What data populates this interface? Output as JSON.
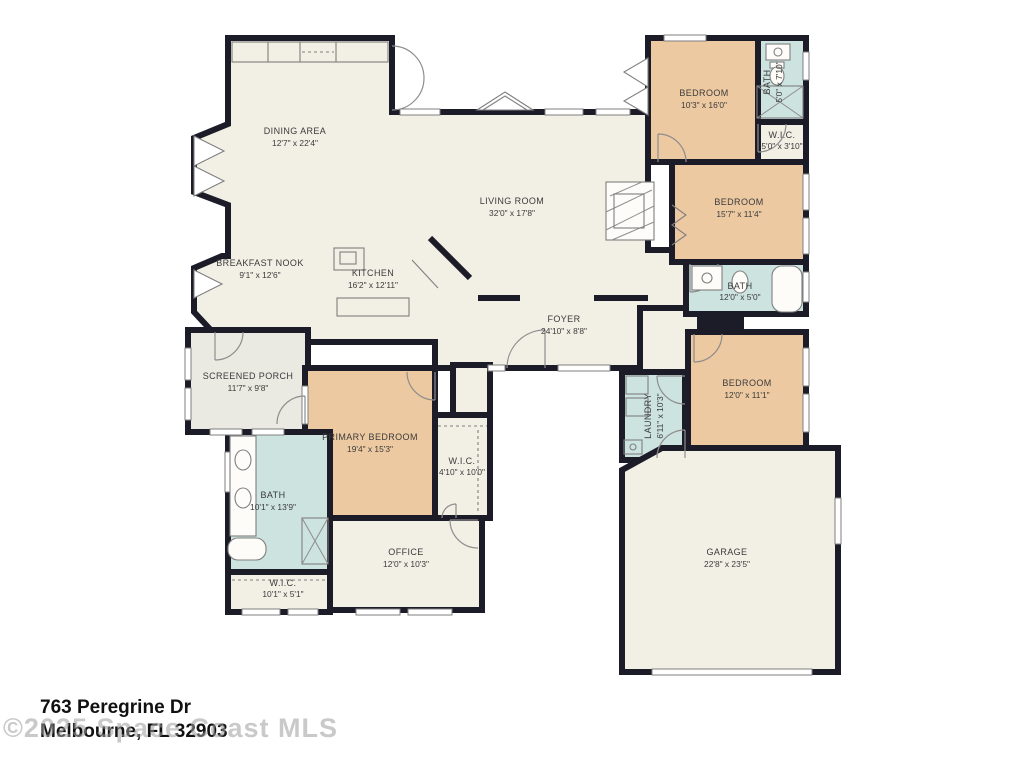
{
  "colors": {
    "wall": "#1c1c28",
    "bedroom": "#edc9a1",
    "bath": "#cde3df",
    "room": "#f2efe5",
    "porch": "#eaeae2",
    "label": "#3b3b3b",
    "address": "#111111",
    "watermark": "#9e9e9e"
  },
  "rooms": [
    {
      "name": "DINING AREA",
      "dims": "12'7\" x 22'4\""
    },
    {
      "name": "LIVING ROOM",
      "dims": "32'0\" x 17'8\""
    },
    {
      "name": "BREAKFAST NOOK",
      "dims": "9'1\" x 12'6\""
    },
    {
      "name": "KITCHEN",
      "dims": "16'2\" x 12'11\""
    },
    {
      "name": "FOYER",
      "dims": "24'10\" x 8'8\""
    },
    {
      "name": "BEDROOM",
      "dims": "10'3\" x 16'0\""
    },
    {
      "name": "BATH",
      "dims": "5'0\" x 7'10\""
    },
    {
      "name": "W.I.C.",
      "dims": "5'0\" x 3'10\""
    },
    {
      "name": "BEDROOM",
      "dims": "15'7\" x 11'4\""
    },
    {
      "name": "BATH",
      "dims": "12'0\" x 5'0\""
    },
    {
      "name": "BEDROOM",
      "dims": "12'0\" x 11'1\""
    },
    {
      "name": "LAUNDRY",
      "dims": "6'11\" x 10'3\""
    },
    {
      "name": "SCREENED PORCH",
      "dims": "11'7\" x 9'8\""
    },
    {
      "name": "PRIMARY BEDROOM",
      "dims": "19'4\" x 15'3\""
    },
    {
      "name": "W.I.C.",
      "dims": "4'10\" x 10'0\""
    },
    {
      "name": "BATH",
      "dims": "10'1\" x 13'9\""
    },
    {
      "name": "OFFICE",
      "dims": "12'0\" x 10'3\""
    },
    {
      "name": "W.I.C.",
      "dims": "10'1\" x 5'1\""
    },
    {
      "name": "GARAGE",
      "dims": "22'8\" x 23'5\""
    }
  ],
  "footer": {
    "address_line1": "763 Peregrine Dr",
    "address_line2": "Melbourne, FL 32903",
    "watermark": "©2025 Space Coast MLS"
  }
}
